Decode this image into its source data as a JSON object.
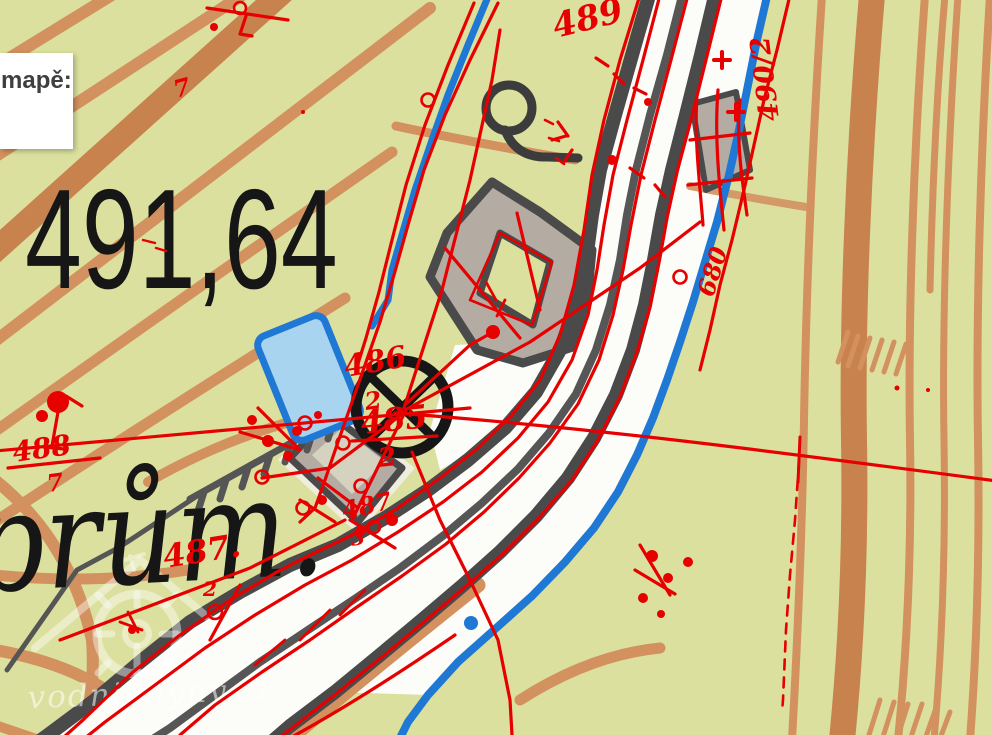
{
  "panel": {
    "label": "mapě:"
  },
  "labels": {
    "elevation": "491,64",
    "abbreviation": "prům."
  },
  "watermark": {
    "text": "vodnimlyny.cz"
  },
  "cad": {
    "n489": "489",
    "n490": "490/2",
    "n680": "680",
    "n486": "486",
    "n486s": "2",
    "n485": "485",
    "n485s": "2",
    "n488": "488",
    "n488s": "7",
    "n487": "487.",
    "n487s": "2",
    "n487b": "487",
    "n487bs": "3",
    "n7": "7"
  },
  "colors": {
    "background": "#dbe09e",
    "contour": "#d2915f",
    "contour_thick": "#c8824e",
    "road_casing": "#4a4a4a",
    "road_fill": "#fcfcf9",
    "stream": "#1f78d3",
    "pond_fill": "#a9d4f0",
    "building_fill": "#b4aba3",
    "overlay_red": "#e60000",
    "mill_symbol": "#161616"
  }
}
